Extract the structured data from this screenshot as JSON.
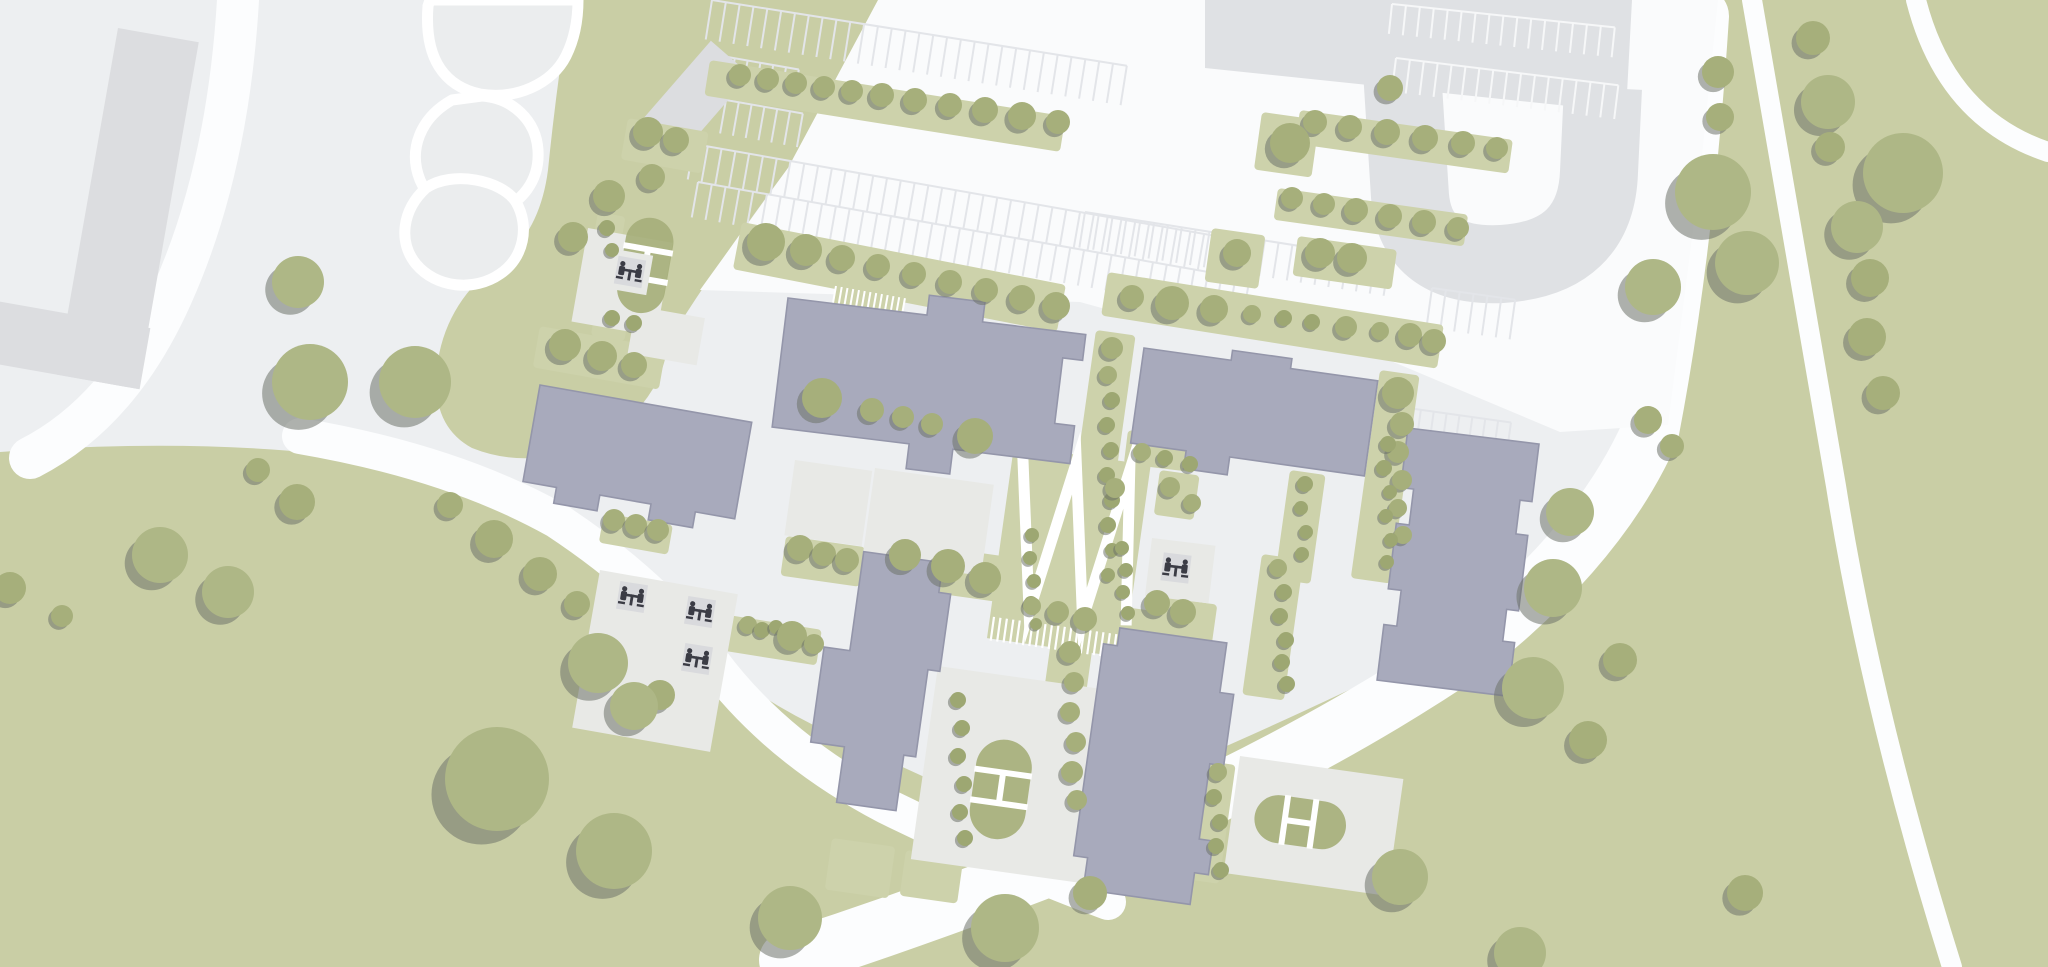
{
  "map": {
    "kind": "architectural-site-plan",
    "width": 2048,
    "height": 967
  },
  "colors": {
    "pavement": "#edeff1",
    "road_white": "#fcfdfe",
    "parking_white": "#fafbfc",
    "grass": "#c9cea5",
    "planter": "#cdd2ab",
    "tree": "#a6af7b",
    "tree_big": "#aeb786",
    "tree_small": "#9da772",
    "tree_shadow": "#6e7369",
    "building": "#a8aabc",
    "building_outline": "#9496aa",
    "context_building": "#dcdde0",
    "context_road": "#dfe1e4",
    "courtyard": "#e8e9e6",
    "pond": "#ebedee",
    "stall_light": "#e3e5e9",
    "stall_white": "#f6f7f8",
    "icon_plate": "#d9dadd",
    "icon_dark": "#3b3c45"
  },
  "greens": [
    {
      "name": "green-field-east",
      "d": "M1695,0 L2048,0 L2048,967 L690,967 Q900,882 1120,792 Q1380,682 1520,602 Q1625,540 1648,432 Q1688,240 1695,0 Z"
    },
    {
      "name": "green-field-southwest",
      "d": "M0,452 Q240,434 420,468 Q558,502 634,586 Q716,680 830,733 Q960,795 1090,850 L1150,967 L0,967 Z"
    },
    {
      "name": "green-wedge-northwest",
      "d": "M570,0 L880,0 Q845,90 788,168 Q718,262 668,342 Q662,402 600,440 Q532,472 472,448 Q428,424 438,360 Q448,300 500,262 Q540,232 548,170 Q556,90 570,0 Z"
    }
  ],
  "ponds": [
    {
      "name": "pond-lobe-1",
      "d": "M428,6 C424,58 444,86 480,94 C516,100 552,84 566,56 C574,40 578,20 578,0 L430,0 Z"
    },
    {
      "name": "pond-lobe-2",
      "d": "M452,100 C420,118 408,150 420,180 C432,208 464,222 494,212 C522,204 540,180 538,150 C536,120 512,98 482,96 Z"
    },
    {
      "name": "pond-lobe-3",
      "d": "M426,188 C402,210 398,242 416,264 C436,288 474,292 500,274 C524,258 530,226 516,202 C502,180 452,170 426,188 Z"
    }
  ],
  "roads": [
    {
      "name": "ring-road-east",
      "d": "M1700,16 Q1685,250 1650,432 Q1600,545 1470,648 Q1318,752 1098,848 Q948,908 788,960",
      "w": 58
    },
    {
      "name": "road-northwest",
      "d": "M238,0 Q228,170 172,295 Q120,412 30,458",
      "w": 42
    },
    {
      "name": "road-southwest",
      "d": "M300,436 Q452,462 556,520 Q656,586 712,662 Q776,748 886,806 Q1000,862 1108,902",
      "w": 36
    },
    {
      "name": "field-path-straight",
      "d": "M1752,0 L1836,486 Q1872,712 1952,967",
      "w": 20
    },
    {
      "name": "field-path-corner-arc",
      "d": "M1916,0 Q1946,118 2048,152",
      "w": 20
    }
  ],
  "parking": {
    "zone": "M878,0 L1718,0 L1700,175 L1668,425 L1560,432 L1360,348 L1152,322 L1080,302 L700,290 L788,168 Z",
    "gray_block": "1205,0 1632,0 1626,112 1205,68",
    "u_road": "M1402,70 L1410,196 Q1416,268 1502,264 Q1596,258 1599,172 L1603,88",
    "u_road_width": 78,
    "stall_rows": [
      {
        "x": 712,
        "y": 0,
        "rot": 9,
        "n": 30,
        "sp": 14,
        "len": 40,
        "c": "light"
      },
      {
        "x": 694,
        "y": 144,
        "rot": 10,
        "n": 40,
        "sp": 14,
        "len": 36,
        "c": "light"
      },
      {
        "x": 698,
        "y": 182,
        "rot": 10,
        "n": 40,
        "sp": 14,
        "len": 36,
        "c": "light"
      },
      {
        "x": 1085,
        "y": 212,
        "rot": 9,
        "n": 22,
        "sp": 14,
        "len": 36,
        "c": "light"
      },
      {
        "x": 722,
        "y": 56,
        "rot": 10,
        "n": 6,
        "sp": 13,
        "len": 34,
        "c": "light"
      },
      {
        "x": 726,
        "y": 100,
        "rot": 10,
        "n": 6,
        "sp": 13,
        "len": 34,
        "c": "light"
      },
      {
        "x": 1408,
        "y": 408,
        "rot": 8,
        "n": 8,
        "sp": 13,
        "len": 34,
        "c": "light"
      },
      {
        "x": 1408,
        "y": 446,
        "rot": 8,
        "n": 8,
        "sp": 13,
        "len": 34,
        "c": "light"
      },
      {
        "x": 1432,
        "y": 288,
        "rot": 8,
        "n": 6,
        "sp": 14,
        "len": 40,
        "c": "light"
      },
      {
        "x": 1392,
        "y": 4,
        "rot": 6,
        "n": 16,
        "sp": 14,
        "len": 30,
        "c": "white"
      },
      {
        "x": 1396,
        "y": 58,
        "rot": 7,
        "n": 16,
        "sp": 14,
        "len": 34,
        "c": "white"
      }
    ]
  },
  "context_buildings": [
    {
      "name": "context-building-L",
      "tx": 118,
      "ty": 28,
      "rot": 10,
      "rects": [
        [
          0,
          0,
          82,
          352
        ],
        [
          -120,
          290,
          204,
          62
        ]
      ]
    },
    {
      "name": "context-building-small",
      "tx": 642,
      "ty": 120,
      "rot": -49,
      "rects": [
        [
          0,
          0,
          105,
          52
        ]
      ]
    }
  ],
  "planters": [
    [
      710,
      60,
      9,
      360,
      36
    ],
    [
      1300,
      110,
      8,
      215,
      34
    ],
    [
      628,
      118,
      10,
      82,
      42
    ],
    [
      1278,
      188,
      8,
      192,
      32
    ],
    [
      742,
      222,
      11,
      330,
      48
    ],
    [
      1108,
      272,
      9,
      340,
      44
    ],
    [
      540,
      326,
      10,
      128,
      42
    ],
    [
      604,
      513,
      10,
      70,
      30
    ],
    [
      800,
      382,
      8,
      200,
      44
    ],
    [
      786,
      536,
      8,
      80,
      40
    ],
    [
      888,
      540,
      8,
      120,
      46
    ],
    [
      1096,
      330,
      8,
      40,
      240
    ],
    [
      1290,
      470,
      8,
      36,
      110
    ],
    [
      1380,
      370,
      8,
      40,
      210
    ],
    [
      728,
      615,
      9,
      95,
      36
    ],
    [
      1018,
      592,
      8,
      160,
      42
    ],
    [
      942,
      686,
      8,
      36,
      164
    ],
    [
      1052,
      634,
      8,
      42,
      180
    ],
    [
      1262,
      554,
      8,
      42,
      142
    ],
    [
      1200,
      760,
      8,
      36,
      120
    ],
    [
      598,
      212,
      10,
      28,
      92
    ],
    [
      596,
      306,
      10,
      34,
      30
    ],
    [
      1212,
      228,
      8,
      54,
      54
    ],
    [
      1262,
      112,
      8,
      58,
      58
    ],
    [
      1298,
      236,
      8,
      100,
      40
    ],
    [
      832,
      838,
      8,
      64,
      52
    ],
    [
      906,
      850,
      8,
      58,
      46
    ],
    [
      1100,
      470,
      8,
      40,
      45
    ],
    [
      1160,
      470,
      8,
      40,
      45
    ],
    [
      1148,
      595,
      8,
      70,
      55
    ],
    [
      1128,
      430,
      7,
      70,
      34
    ]
  ],
  "courtyards": [
    [
      588,
      228,
      10,
      86,
      95
    ],
    [
      636,
      306,
      10,
      70,
      48
    ],
    [
      600,
      570,
      10,
      140,
      160
    ],
    [
      795,
      460,
      8,
      78,
      76
    ],
    [
      875,
      468,
      8,
      120,
      92
    ],
    [
      938,
      666,
      8,
      180,
      195
    ],
    [
      1152,
      538,
      7,
      64,
      58
    ],
    [
      1240,
      756,
      8,
      165,
      118
    ]
  ],
  "hatches": [
    {
      "x": 836,
      "y": 286,
      "rot": 10,
      "w": 70,
      "h": 22,
      "n": 12
    }
  ],
  "zigzag": {
    "tx": 1014,
    "ty": 446,
    "rot": 8,
    "w": 138,
    "h": 170,
    "path": "M10,8 L38,162 L64,8 L92,162 L118,8 L136,162",
    "hatch": {
      "y": 172,
      "h": 24,
      "n": 22,
      "sp": 6.5
    }
  },
  "ovals": [
    {
      "name": "play-oval-north",
      "x": 630,
      "y": 214,
      "rot": 10,
      "w": 48,
      "h": 96,
      "type": "v"
    },
    {
      "name": "play-oval-center",
      "x": 980,
      "y": 736,
      "rot": 8,
      "w": 56,
      "h": 100,
      "type": "v"
    },
    {
      "name": "play-oval-southeast",
      "x": 1258,
      "y": 792,
      "rot": 8,
      "w": 92,
      "h": 48,
      "type": "h"
    }
  ],
  "buildings": [
    {
      "name": "building-north",
      "tx": 788,
      "ty": 298,
      "rot": 7,
      "pts": "0,0 140,0 140,-20 196,-20 196,0 300,0 300,26 280,26 280,92 300,92 300,130 182,130 182,155 138,155 138,130 0,130"
    },
    {
      "name": "building-west",
      "tx": 540,
      "ty": 385,
      "rot": 10,
      "pts": "0,0 215,0 215,98 175,98 175,114 130,114 130,98 78,98 78,114 34,114 34,98 0,98"
    },
    {
      "name": "building-northeast",
      "tx": 1144,
      "ty": 348,
      "rot": 8,
      "pts": "0,0 88,0 88,-10 148,-10 148,0 236,0 236,96 100,96 100,114 56,114 56,96 0,96"
    },
    {
      "name": "building-east",
      "tx": 1408,
      "ty": 428,
      "rot": 7,
      "pts": "0,0 132,0 132,58 120,58 120,92 132,92 132,168 120,168 120,200 132,200 132,254 0,254 0,198 13,198 13,162 0,162 0,96 13,96 13,60 0,60"
    },
    {
      "name": "building-south-center",
      "tx": 838,
      "ty": 548,
      "rot": 8,
      "pts": "26,0 106,0 106,30 118,30 118,108 106,108 106,196 94,196 94,252 34,252 34,196 0,196 0,100 26,100"
    },
    {
      "name": "building-south-east",
      "tx": 1106,
      "ty": 626,
      "rot": 8,
      "pts": "0,18 14,18 14,0 122,0 122,50 136,50 136,122 122,122 122,198 136,198 136,232 122,232 122,264 14,264 14,232 0,232"
    }
  ],
  "picnic_tables": [
    [
      630,
      272,
      10
    ],
    [
      632,
      597,
      9
    ],
    [
      700,
      612,
      9
    ],
    [
      697,
      659,
      9
    ],
    [
      1176,
      568,
      7
    ]
  ],
  "trees": [
    [
      609,
      196,
      16
    ],
    [
      573,
      237,
      15
    ],
    [
      652,
      177,
      13
    ],
    [
      298,
      282,
      26
    ],
    [
      310,
      382,
      38
    ],
    [
      415,
      382,
      36
    ],
    [
      740,
      75,
      11
    ],
    [
      768,
      79,
      11
    ],
    [
      796,
      83,
      11
    ],
    [
      824,
      87,
      11
    ],
    [
      852,
      91,
      11
    ],
    [
      882,
      95,
      12
    ],
    [
      915,
      100,
      12
    ],
    [
      950,
      105,
      12
    ],
    [
      985,
      110,
      13
    ],
    [
      1022,
      116,
      14
    ],
    [
      1058,
      122,
      12
    ],
    [
      1315,
      122,
      12
    ],
    [
      1350,
      127,
      12
    ],
    [
      1387,
      132,
      13
    ],
    [
      1425,
      138,
      13
    ],
    [
      1463,
      143,
      12
    ],
    [
      1497,
      148,
      11
    ],
    [
      648,
      132,
      15
    ],
    [
      676,
      140,
      13
    ],
    [
      1292,
      198,
      11
    ],
    [
      1324,
      204,
      11
    ],
    [
      1356,
      210,
      12
    ],
    [
      1390,
      216,
      12
    ],
    [
      1424,
      222,
      12
    ],
    [
      1458,
      228,
      11
    ],
    [
      766,
      242,
      19
    ],
    [
      806,
      250,
      16
    ],
    [
      842,
      258,
      13
    ],
    [
      878,
      266,
      12
    ],
    [
      914,
      274,
      12
    ],
    [
      950,
      282,
      12
    ],
    [
      986,
      290,
      12
    ],
    [
      1022,
      298,
      13
    ],
    [
      1056,
      306,
      14
    ],
    [
      1132,
      297,
      12
    ],
    [
      1172,
      303,
      17
    ],
    [
      1214,
      309,
      14
    ],
    [
      1252,
      314,
      9
    ],
    [
      1284,
      318,
      8
    ],
    [
      1312,
      322,
      8
    ],
    [
      1346,
      327,
      11
    ],
    [
      1380,
      331,
      9
    ],
    [
      1410,
      335,
      12
    ],
    [
      1434,
      341,
      12
    ],
    [
      1320,
      253,
      15
    ],
    [
      1352,
      258,
      15
    ],
    [
      1290,
      143,
      20
    ],
    [
      1390,
      88,
      13
    ],
    [
      1237,
      253,
      14
    ],
    [
      1718,
      72,
      16
    ],
    [
      1720,
      117,
      14
    ],
    [
      1813,
      38,
      17
    ],
    [
      1828,
      102,
      27
    ],
    [
      1830,
      147,
      15
    ],
    [
      1903,
      173,
      40
    ],
    [
      1713,
      192,
      38
    ],
    [
      1747,
      263,
      32
    ],
    [
      1857,
      227,
      26
    ],
    [
      1870,
      278,
      19
    ],
    [
      1867,
      337,
      19
    ],
    [
      1883,
      393,
      17
    ],
    [
      1653,
      287,
      28
    ],
    [
      1648,
      420,
      14
    ],
    [
      1672,
      446,
      12
    ],
    [
      1570,
      512,
      24
    ],
    [
      1553,
      588,
      29
    ],
    [
      1533,
      688,
      31
    ],
    [
      1588,
      740,
      19
    ],
    [
      1620,
      660,
      17
    ],
    [
      1400,
      877,
      28
    ],
    [
      1520,
      953,
      26
    ],
    [
      1745,
      893,
      18
    ],
    [
      497,
      779,
      52
    ],
    [
      614,
      851,
      38
    ],
    [
      790,
      918,
      32
    ],
    [
      1005,
      928,
      34
    ],
    [
      1090,
      893,
      17
    ],
    [
      660,
      695,
      15
    ],
    [
      598,
      663,
      30
    ],
    [
      634,
      706,
      24
    ],
    [
      160,
      555,
      28
    ],
    [
      228,
      592,
      26
    ],
    [
      297,
      502,
      18
    ],
    [
      258,
      470,
      12
    ],
    [
      10,
      588,
      16
    ],
    [
      62,
      616,
      11
    ],
    [
      450,
      505,
      13
    ],
    [
      494,
      539,
      19
    ],
    [
      540,
      574,
      17
    ],
    [
      577,
      604,
      13
    ],
    [
      565,
      345,
      16
    ],
    [
      602,
      356,
      15
    ],
    [
      634,
      365,
      13
    ],
    [
      614,
      520,
      11
    ],
    [
      636,
      525,
      11
    ],
    [
      658,
      530,
      11
    ],
    [
      822,
      398,
      20
    ],
    [
      872,
      410,
      12
    ],
    [
      903,
      417,
      11
    ],
    [
      932,
      424,
      11
    ],
    [
      975,
      436,
      18
    ],
    [
      800,
      548,
      13
    ],
    [
      824,
      554,
      12
    ],
    [
      847,
      560,
      12
    ],
    [
      905,
      555,
      16
    ],
    [
      948,
      566,
      17
    ],
    [
      985,
      578,
      16
    ],
    [
      1112,
      348,
      11
    ],
    [
      1108,
      375,
      9
    ],
    [
      1112,
      400,
      8
    ],
    [
      1107,
      425,
      8
    ],
    [
      1111,
      450,
      8
    ],
    [
      1107,
      475,
      8
    ],
    [
      1112,
      500,
      8
    ],
    [
      1108,
      525,
      8
    ],
    [
      1112,
      550,
      7
    ],
    [
      1108,
      575,
      7
    ],
    [
      1305,
      484,
      8
    ],
    [
      1301,
      508,
      7
    ],
    [
      1306,
      532,
      7
    ],
    [
      1302,
      554,
      7
    ],
    [
      1398,
      393,
      16
    ],
    [
      1402,
      424,
      12
    ],
    [
      1398,
      452,
      11
    ],
    [
      1402,
      480,
      10
    ],
    [
      1398,
      508,
      9
    ],
    [
      1403,
      535,
      9
    ],
    [
      1032,
      535,
      7
    ],
    [
      1030,
      558,
      7
    ],
    [
      1034,
      581,
      7
    ],
    [
      1031,
      603,
      7
    ],
    [
      1036,
      624,
      6
    ],
    [
      1122,
      548,
      7
    ],
    [
      1126,
      570,
      7
    ],
    [
      1123,
      592,
      7
    ],
    [
      1128,
      613,
      7
    ],
    [
      1115,
      488,
      10
    ],
    [
      1170,
      487,
      10
    ],
    [
      1192,
      503,
      9
    ],
    [
      607,
      228,
      8
    ],
    [
      612,
      250,
      7
    ],
    [
      612,
      318,
      8
    ],
    [
      634,
      323,
      8
    ],
    [
      748,
      625,
      9
    ],
    [
      762,
      630,
      8
    ],
    [
      776,
      627,
      7
    ],
    [
      792,
      636,
      15
    ],
    [
      814,
      644,
      10
    ],
    [
      1032,
      606,
      9
    ],
    [
      1058,
      612,
      11
    ],
    [
      1085,
      619,
      12
    ],
    [
      958,
      700,
      8
    ],
    [
      962,
      728,
      8
    ],
    [
      958,
      756,
      8
    ],
    [
      964,
      784,
      8
    ],
    [
      960,
      812,
      8
    ],
    [
      965,
      838,
      8
    ],
    [
      1070,
      652,
      11
    ],
    [
      1074,
      682,
      10
    ],
    [
      1070,
      712,
      10
    ],
    [
      1076,
      742,
      10
    ],
    [
      1072,
      772,
      11
    ],
    [
      1077,
      800,
      10
    ],
    [
      1278,
      568,
      9
    ],
    [
      1284,
      592,
      8
    ],
    [
      1280,
      616,
      8
    ],
    [
      1286,
      640,
      8
    ],
    [
      1282,
      662,
      8
    ],
    [
      1287,
      684,
      8
    ],
    [
      1388,
      444,
      8
    ],
    [
      1384,
      468,
      8
    ],
    [
      1390,
      492,
      7
    ],
    [
      1386,
      516,
      7
    ],
    [
      1391,
      540,
      7
    ],
    [
      1387,
      562,
      7
    ],
    [
      1218,
      772,
      9
    ],
    [
      1214,
      797,
      8
    ],
    [
      1220,
      822,
      8
    ],
    [
      1216,
      846,
      8
    ],
    [
      1221,
      870,
      8
    ],
    [
      1157,
      603,
      13
    ],
    [
      1183,
      612,
      13
    ],
    [
      1142,
      452,
      9
    ],
    [
      1165,
      458,
      8
    ],
    [
      1190,
      464,
      8
    ]
  ]
}
